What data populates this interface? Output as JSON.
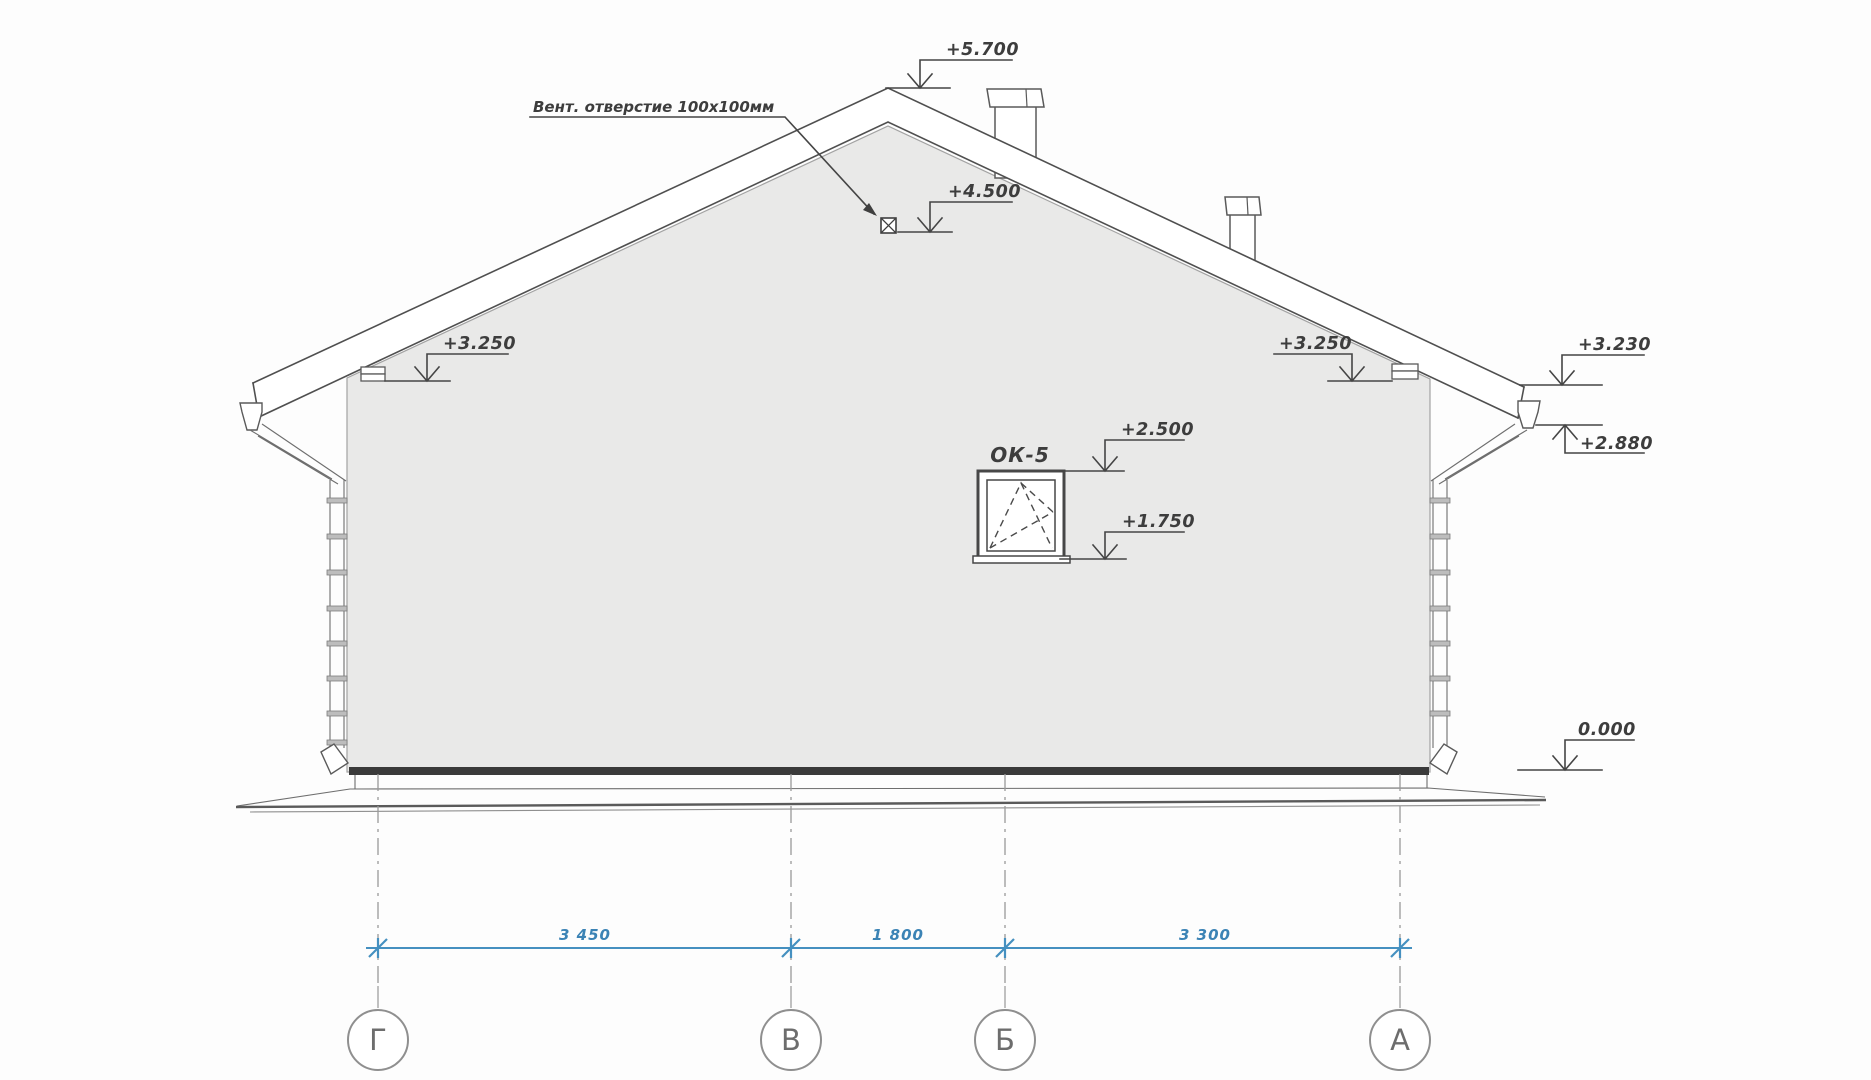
{
  "title": "Фасад Г-А (торцевой фасад дома)",
  "labels": {
    "vent": "Вент. отверстие 100х100мм",
    "window": "ОК-5"
  },
  "marks": {
    "ridge": "+5.700",
    "vent_hole": "+4.500",
    "eave_left": "+3.250",
    "eave_right": "+3.250",
    "roof_edge_right": "+3.230",
    "gutter_right": "+2.880",
    "window_top": "+2.500",
    "window_bottom": "+1.750",
    "ground": "0.000"
  },
  "dims": {
    "spans": [
      "3 450",
      "1 800",
      "3 300"
    ]
  },
  "axes": {
    "labels": [
      "Г",
      "В",
      "Б",
      "А"
    ]
  },
  "colors": {
    "dimension_blue": "#4590c0",
    "dimension_text_blue": "#3b83b5",
    "line_gray": "#4f4f4f",
    "wall_fill": "#e9e9e8",
    "plinth_dark": "#3a3a3a"
  }
}
